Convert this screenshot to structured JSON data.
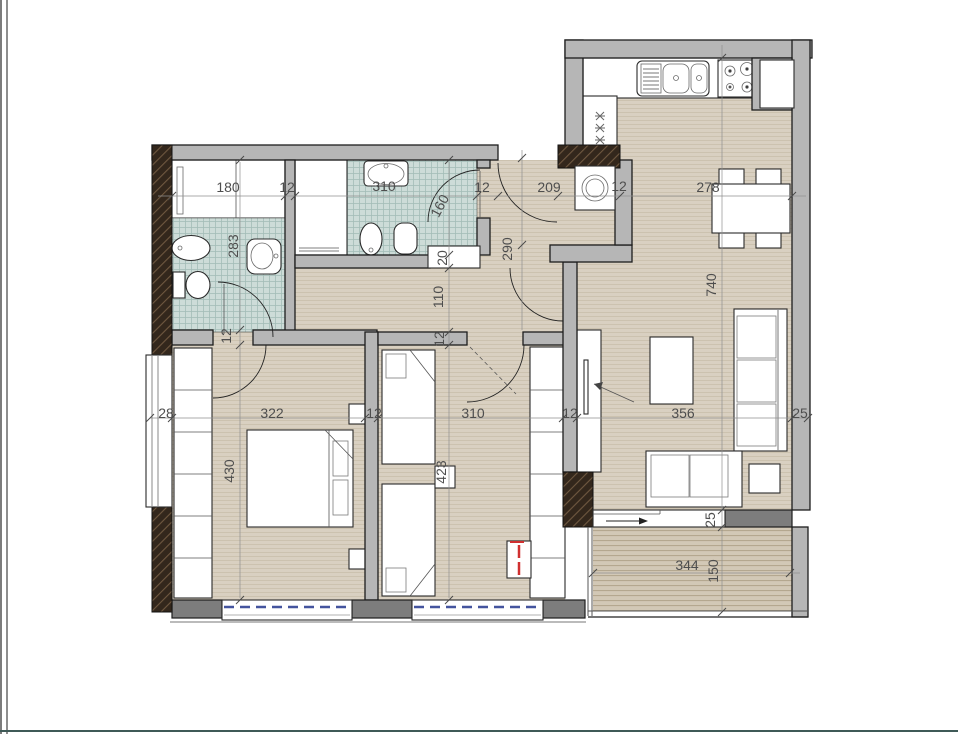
{
  "colors": {
    "floor": "#d9d0c1",
    "tile": "#cddcd8",
    "balcony_floor": "#d2c8b6",
    "wall": "#b6b6b6",
    "wall_dark": "#7d7d7d",
    "structural_hatch": "#33271c",
    "window_glazing": "#44549e",
    "alert_red": "#d03030"
  },
  "fixtures": [
    "kitchen-sink",
    "stove",
    "fridge",
    "washing-machine",
    "dining-table",
    "dining-chair",
    "sofa",
    "coffee-table",
    "side-table",
    "tv-console",
    "double-bed",
    "single-bed",
    "nightstand",
    "wardrobe",
    "toilet",
    "bidet",
    "wash-basin",
    "shower",
    "door-swing",
    "balcony"
  ],
  "dims": {
    "d180": "180",
    "d12a": "12",
    "d310a": "310",
    "d12b": "12",
    "d209": "209",
    "d12c": "12",
    "d278": "278",
    "d283": "283",
    "d160": "160",
    "d20": "20",
    "d110": "110",
    "d290": "290",
    "d740": "740",
    "d12d": "12",
    "d28": "28",
    "d322": "322",
    "d12e": "12",
    "d310b": "310",
    "d12f": "12",
    "d356": "356",
    "d25a": "25",
    "d430": "430",
    "d423": "423",
    "d12g": "12",
    "d25b": "25",
    "d344": "344",
    "d150": "150"
  }
}
